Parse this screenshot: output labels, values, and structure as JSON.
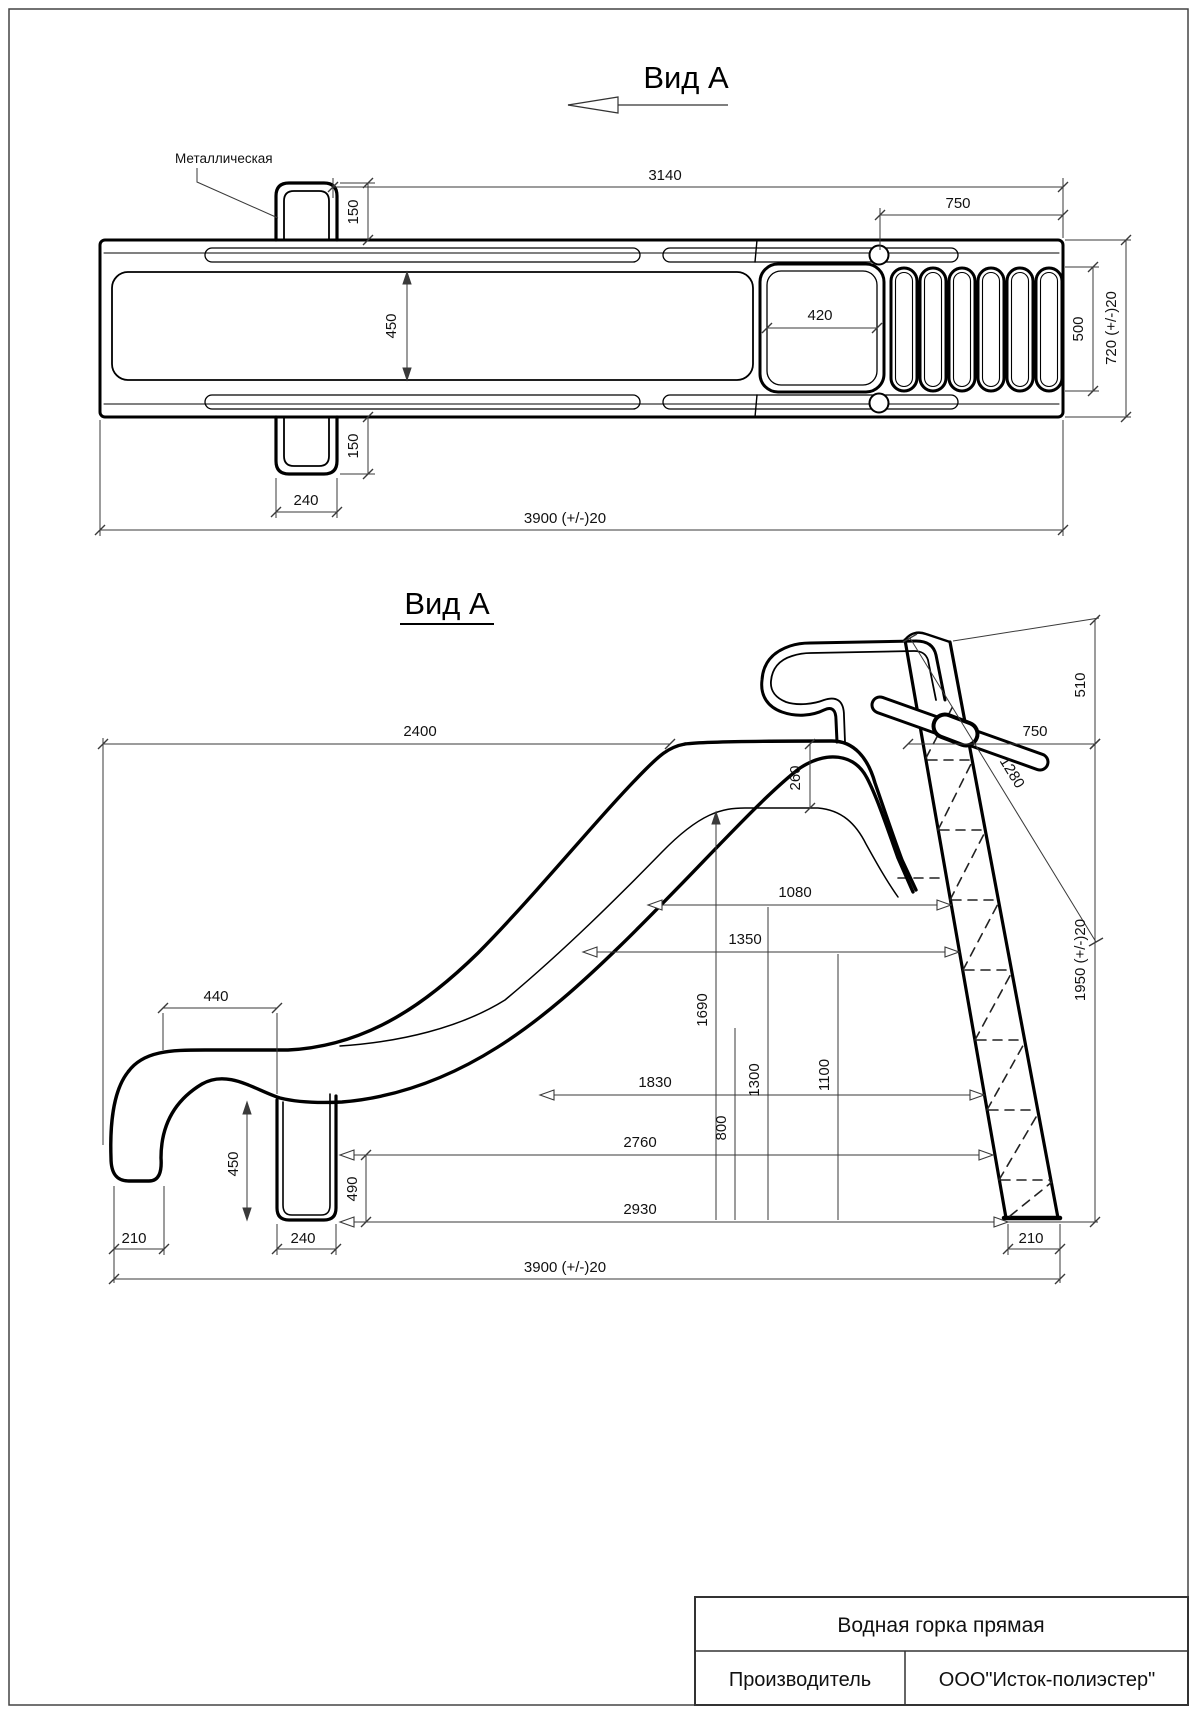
{
  "drawing": {
    "top_view": {
      "title": "Вид А",
      "material_label": "Металлическая",
      "dims": {
        "d3140": "3140",
        "d750": "750",
        "d150_top": "150",
        "d450": "450",
        "d420": "420",
        "d500": "500",
        "d720": "720 (+/-)20",
        "d150_bottom": "150",
        "d240": "240",
        "d3900": "3900 (+/-)20"
      }
    },
    "side_view": {
      "title": "Вид А",
      "dims": {
        "d2400": "2400",
        "d260": "260",
        "d750": "750",
        "d510": "510",
        "d1280": "1280",
        "d1080": "1080",
        "d1350": "1350",
        "d1950": "1950 (+/-)20",
        "d440": "440",
        "d1830": "1830",
        "d1690": "1690",
        "d1300": "1300",
        "d1100": "1100",
        "d800": "800",
        "d2760": "2760",
        "d450": "450",
        "d490": "490",
        "d2930": "2930",
        "d210_left": "210",
        "d240": "240",
        "d210_right": "210",
        "d3900": "3900 (+/-)20"
      }
    },
    "title_block": {
      "product_name": "Водная горка прямая",
      "manufacturer_label": "Производитель",
      "manufacturer_value": "ООО\"Исток-полиэстер\""
    }
  }
}
